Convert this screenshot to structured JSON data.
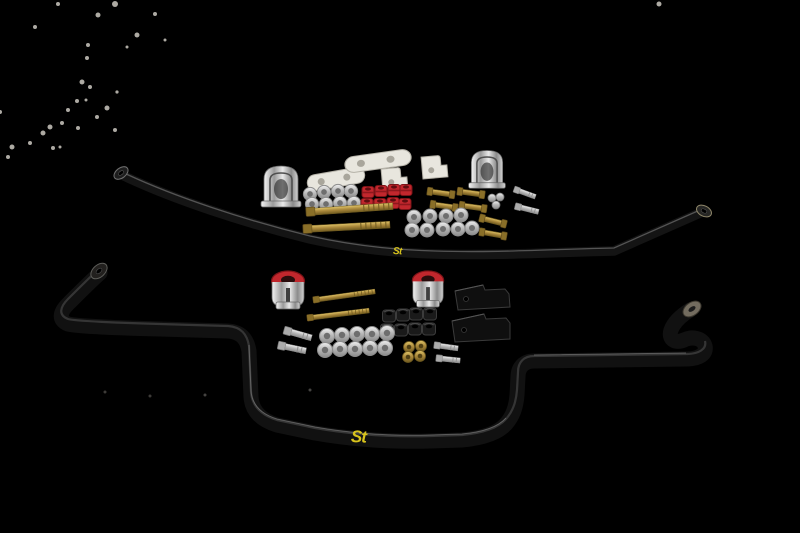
{
  "scene": {
    "type": "product-photo",
    "background": "#000000",
    "description": "ST suspension sway bar set on a black background: a thin front anti-roll bar at top, a thick rear anti-roll bar below, with two hardware kits of clamps, bushings, brackets, bolts and washers between them"
  },
  "branding": {
    "front_bar_logo": "St",
    "rear_bar_logo": "St"
  },
  "colors": {
    "background": "#000000",
    "bar-black": "#121212",
    "bar-sheen": "#555555",
    "logo-yellow": "#d8c31c",
    "chrome-light": "#f0f0f0",
    "chrome-dark": "#8a8a8a",
    "bushing-red": "#c1272d",
    "bushing-red-dark": "#7c1317",
    "hardware-gold": "#b3953a",
    "hardware-gold-dark": "#6f5a1f",
    "hardware-silver": "#c9c9c9",
    "bracket-white": "#e8e6de",
    "rubber-black": "#1a1a1a",
    "speckle": "#cdc9c1"
  },
  "parts": {
    "front_bar": "thin black front sway bar with yellow St logo",
    "rear_bar": "thick black rear sway bar with yellow St logo",
    "front_kit": [
      "chrome saddle clamp",
      "white mounting plate x2",
      "white L-bracket x2",
      "chrome saddle clamp with rubber",
      "red polyurethane bushings x8",
      "zinc washer clusters x2",
      "gold long bolts x2",
      "gold end-link bolts x6",
      "silver nut cluster",
      "silver bolts x2"
    ],
    "rear_kit": [
      "chrome clamp with red bushing x2",
      "gold long bolts x2",
      "black rubber bushings x8",
      "black mounting bracket x2",
      "silver bolts x4",
      "zinc washer cluster",
      "gold washers x4"
    ]
  }
}
